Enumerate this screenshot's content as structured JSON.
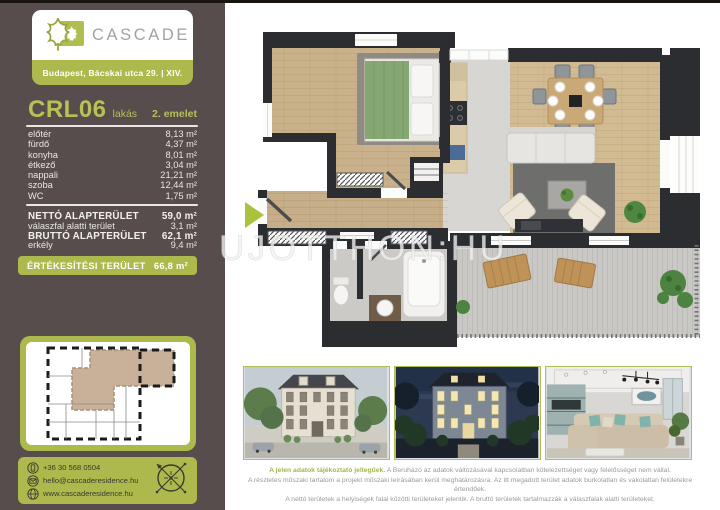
{
  "brand": {
    "name": "CASCADE",
    "address": "Budapest, Bácskai utca 29. | XIV."
  },
  "unit": {
    "code": "CRL06",
    "type": "lakás",
    "floor": "2. emelet"
  },
  "rooms": [
    {
      "name": "előtér",
      "area": "8,13 m²"
    },
    {
      "name": "fürdő",
      "area": "4,37 m²"
    },
    {
      "name": "konyha",
      "area": "8,01 m²"
    },
    {
      "name": "étkező",
      "area": "3,04 m²"
    },
    {
      "name": "nappali",
      "area": "21,21 m²"
    },
    {
      "name": "szoba",
      "area": "12,44 m²"
    },
    {
      "name": "WC",
      "area": "1,75 m²"
    }
  ],
  "totals": [
    {
      "label": "NETTÓ ALAPTERÜLET",
      "value": "59,0 m²"
    },
    {
      "label": "válaszfal alatti terület",
      "value": "3,1 m²"
    },
    {
      "label": "BRUTTÓ ALAPTERÜLET",
      "value": "62,1 m²"
    },
    {
      "label": "erkély",
      "value": "9,4 m²"
    }
  ],
  "sales": {
    "label": "ÉRTÉKESÍTÉSI TERÜLET",
    "value": "66,8 m²"
  },
  "contact": {
    "phone": "+36 30 568 0504",
    "email": "hello@cascaderesidence.hu",
    "website": "www.cascaderesidence.hu"
  },
  "watermark": "UJOTTHON:HU",
  "disclaimer": {
    "lead": "A jelen adatok tájékoztató jellegűek.",
    "line1": "A Beruházó az adatok változásával kapcsolatban kötelezettséget vagy felelősséget nem vállal.",
    "line2": "A részletes műszaki tartalom a projekt műszaki leírásában kerül meghatározásra. Az itt megadott terület adatok burkolatlan és vakolatlan felületekre értendőek.",
    "line3": "A nettó területek a helyiségek falai közötti területeket jelentik. A bruttó területek tartalmazzák a válaszfalak alatti területeket."
  },
  "colors": {
    "accent_green": "#aeb94d",
    "sidebar_bg": "#574d4c",
    "wall_dark": "#2c2d31",
    "wood_floor": "#cdb58e",
    "unit_code_green": "#b6c156"
  }
}
